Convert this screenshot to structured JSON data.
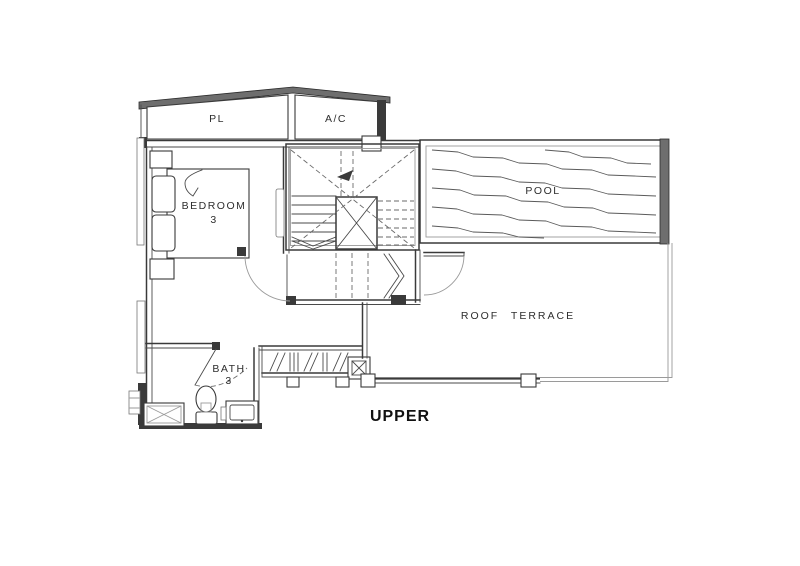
{
  "floor_title": "UPPER",
  "labels": {
    "pl": "PL",
    "ac": "A/C",
    "bedroom_line1": "BEDROOM",
    "bedroom_line2": "3",
    "pool": "POOL",
    "roof_terrace": "ROOF TERRACE",
    "bath_line1": "BATH",
    "bath_line2": "3"
  },
  "colors": {
    "wall_line": "#3a3a3a",
    "light_line": "#9a9a9a",
    "solid_fill": "#6e6e6e",
    "background": "#ffffff",
    "text": "#2e2e2e"
  }
}
